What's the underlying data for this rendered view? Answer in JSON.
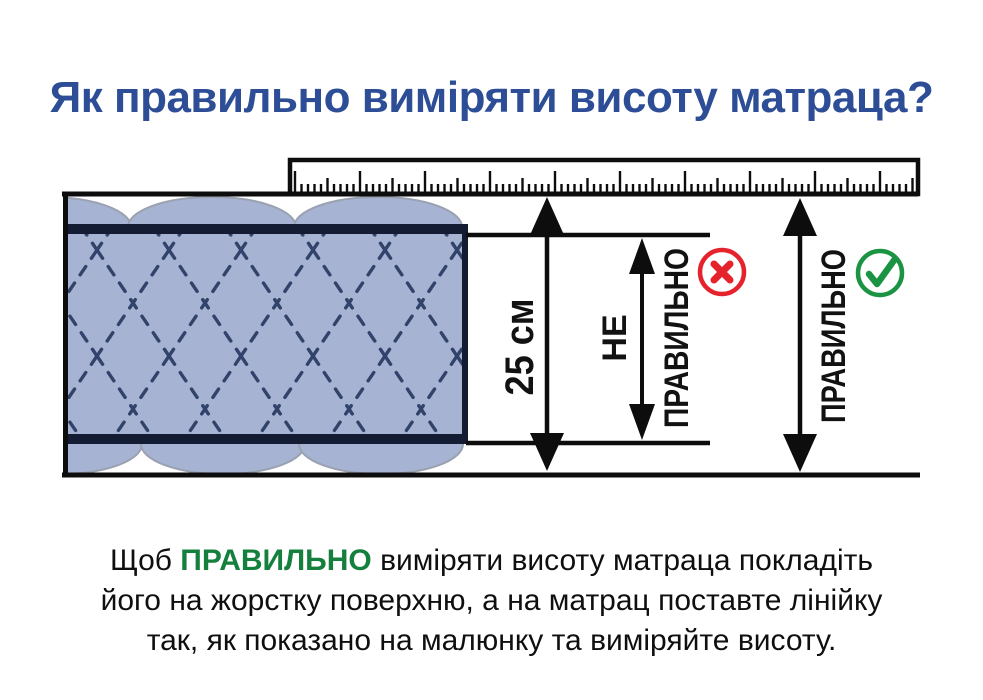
{
  "title": {
    "text": "Як правильно виміряти висоту матраца?",
    "color": "#2d4e96"
  },
  "diagram": {
    "labels": {
      "height": "25 см",
      "wrong_line1": "НЕ",
      "wrong_line2": "ПРАВИЛЬНО",
      "correct": "ПРАВИЛЬНО"
    },
    "icons": {
      "wrong": "cross-in-red-circle",
      "correct": "check-in-green-circle"
    },
    "colors": {
      "mattress_fill": "#a7b3d3",
      "quilt_stitch": "#32436b",
      "mattress_border": "#131c33",
      "bulge_outline": "#9aa1b0",
      "line_black": "#0d0d0d",
      "wrong_red": "#e5232d",
      "correct_green": "#1a9342"
    }
  },
  "caption": {
    "line1_pre": "Щоб ",
    "line1_highlight": "ПРАВИЛЬНО",
    "line1_post": " виміряти висоту матраца покладіть",
    "line2": "його на жорстку поверхню, а на матрац поставте лінійку",
    "line3": "так, як показано на малюнку та виміряйте висоту.",
    "highlight_color": "#15803d"
  }
}
